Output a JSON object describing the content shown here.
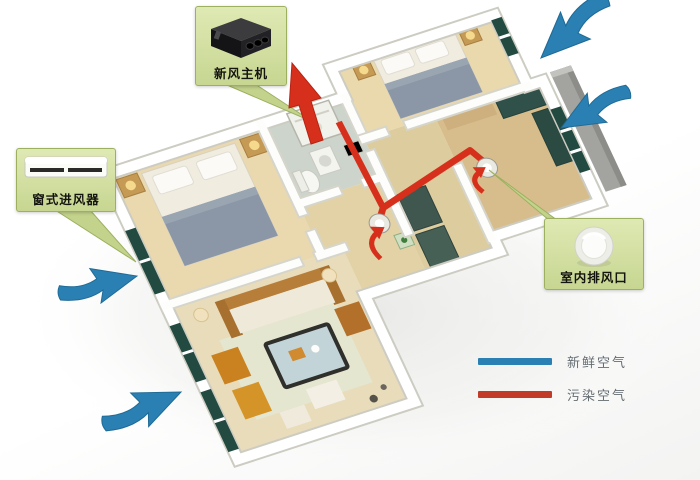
{
  "callouts": {
    "fresh_air_unit": {
      "label": "新风主机",
      "icon": "fresh-air-main-unit-image"
    },
    "window_inlet": {
      "label": "窗式进风器",
      "icon": "window-air-inlet-image"
    },
    "indoor_exhaust": {
      "label": "室内排风口",
      "icon": "round-ceiling-vent-image"
    }
  },
  "legend": {
    "items": [
      {
        "label": "新鲜空气",
        "color": "#2a80b2"
      },
      {
        "label": "污染空气",
        "color": "#c23a28"
      }
    ]
  },
  "diagram": {
    "fresh_air_arrow_count": 4,
    "exhaust_arrow_count": 1,
    "ceiling_vent_count": 2,
    "colors": {
      "fresh_air_arrow": "#2a80b2",
      "polluted_air_duct": "#d6301c",
      "callout_background": "#d3e0a2",
      "callout_border": "#9cb060",
      "wall": "#ffffff",
      "floor": "#e8dcb4",
      "bathroom_floor": "#ccd4cb",
      "window_glass": "#224a40",
      "outside_slab": "#a3a39f"
    }
  }
}
